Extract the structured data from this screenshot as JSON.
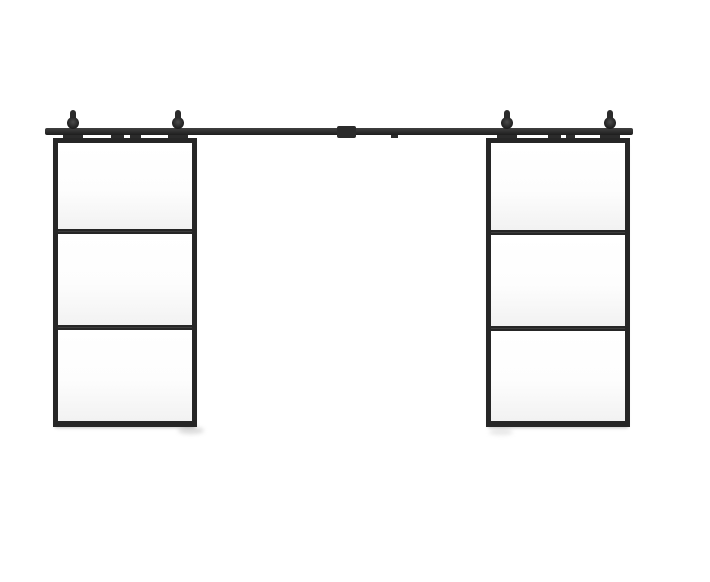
{
  "image": {
    "description": "Double sliding barn doors, each with three clear glass lites in a black metal frame, hung by two round rollers per door on a black top-mount sliding rail with a center connector plate"
  },
  "colors": {
    "background": "#ffffff",
    "metal": "#2b2b2b",
    "metal_light": "#404040",
    "metal_dark": "#1e1e1e",
    "frame": "#262626",
    "glass_top": "#ffffff",
    "glass_mid": "#fdfdfd",
    "glass_bottom": "#f2f2f2"
  },
  "rail": {
    "x": 45,
    "y": 128,
    "width": 588,
    "height": 7,
    "connector": {
      "x": 337,
      "y": 126,
      "width": 19,
      "height": 12
    },
    "spacers": [
      {
        "x": 111,
        "w": 13,
        "h": 3
      },
      {
        "x": 130,
        "w": 11,
        "h": 3
      },
      {
        "x": 391,
        "w": 7,
        "h": 3
      },
      {
        "x": 548,
        "w": 13,
        "h": 3
      },
      {
        "x": 566,
        "w": 9,
        "h": 3
      }
    ]
  },
  "roller_geometry": {
    "knob_w": 6,
    "knob_h": 7,
    "knob_top": 110,
    "wheel_d": 12,
    "wheel_top": 117,
    "strap_w": 20,
    "strap_h": 6,
    "strap_top": 134
  },
  "rollers": [
    {
      "cx": 73
    },
    {
      "cx": 178
    },
    {
      "cx": 507
    },
    {
      "cx": 610
    }
  ],
  "doors": [
    {
      "id": "left-sliding-door",
      "x": 53,
      "y": 138,
      "width": 144,
      "height": 289,
      "frame": 5,
      "bottom_frame": 6,
      "panel_count": 3,
      "divider_offsets": [
        86,
        182
      ],
      "divider_h": 5
    },
    {
      "id": "right-sliding-door",
      "x": 486,
      "y": 138,
      "width": 144,
      "height": 289,
      "frame": 5,
      "bottom_frame": 6,
      "panel_count": 3,
      "divider_offsets": [
        87,
        183
      ],
      "divider_h": 5
    }
  ],
  "floor_marks": [
    {
      "x": 181,
      "y": 422,
      "width": 12,
      "height": 4,
      "color": "#8c8c8c",
      "blur": 1,
      "opacity": 0.8
    },
    {
      "x": 178,
      "y": 427,
      "width": 26,
      "height": 7,
      "color": "#c0c0c0",
      "blur": 2,
      "opacity": 0.55
    },
    {
      "x": 489,
      "y": 429,
      "width": 24,
      "height": 6,
      "color": "#cfcfcf",
      "blur": 2,
      "opacity": 0.5
    }
  ]
}
